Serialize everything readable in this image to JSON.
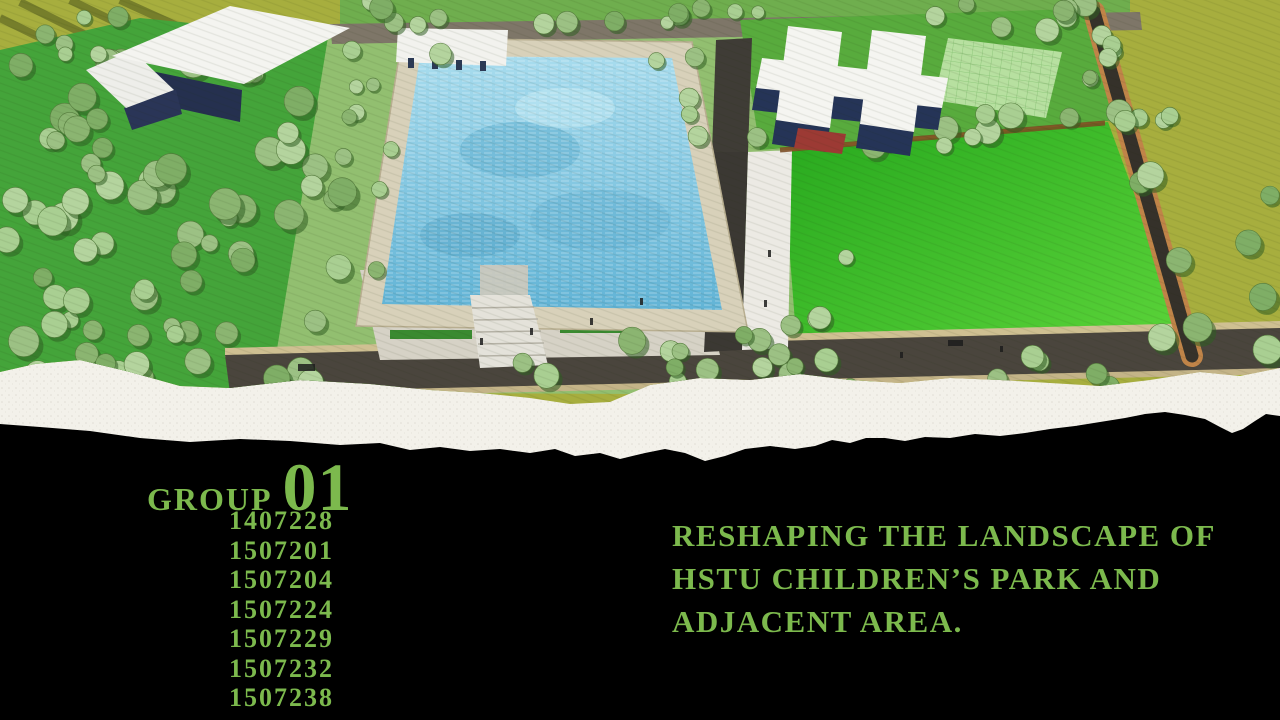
{
  "slide": {
    "background_color": "#000000",
    "accent_color": "#7cb94d"
  },
  "hero": {
    "name": "aerial-masterplan-render",
    "alt": "Aerial render of park masterplan with pool, lawns, orchard and buildings"
  },
  "group": {
    "label": "GROUP",
    "number": "01",
    "member_ids": [
      "1407228",
      "1507201",
      "1507204",
      "1507224",
      "1507229",
      "1507232",
      "1507238"
    ]
  },
  "title": {
    "lines": [
      "RESHAPING THE LANDSCAPE OF",
      "HSTU CHILDREN’S PARK AND",
      "ADJACENT AREA."
    ]
  }
}
